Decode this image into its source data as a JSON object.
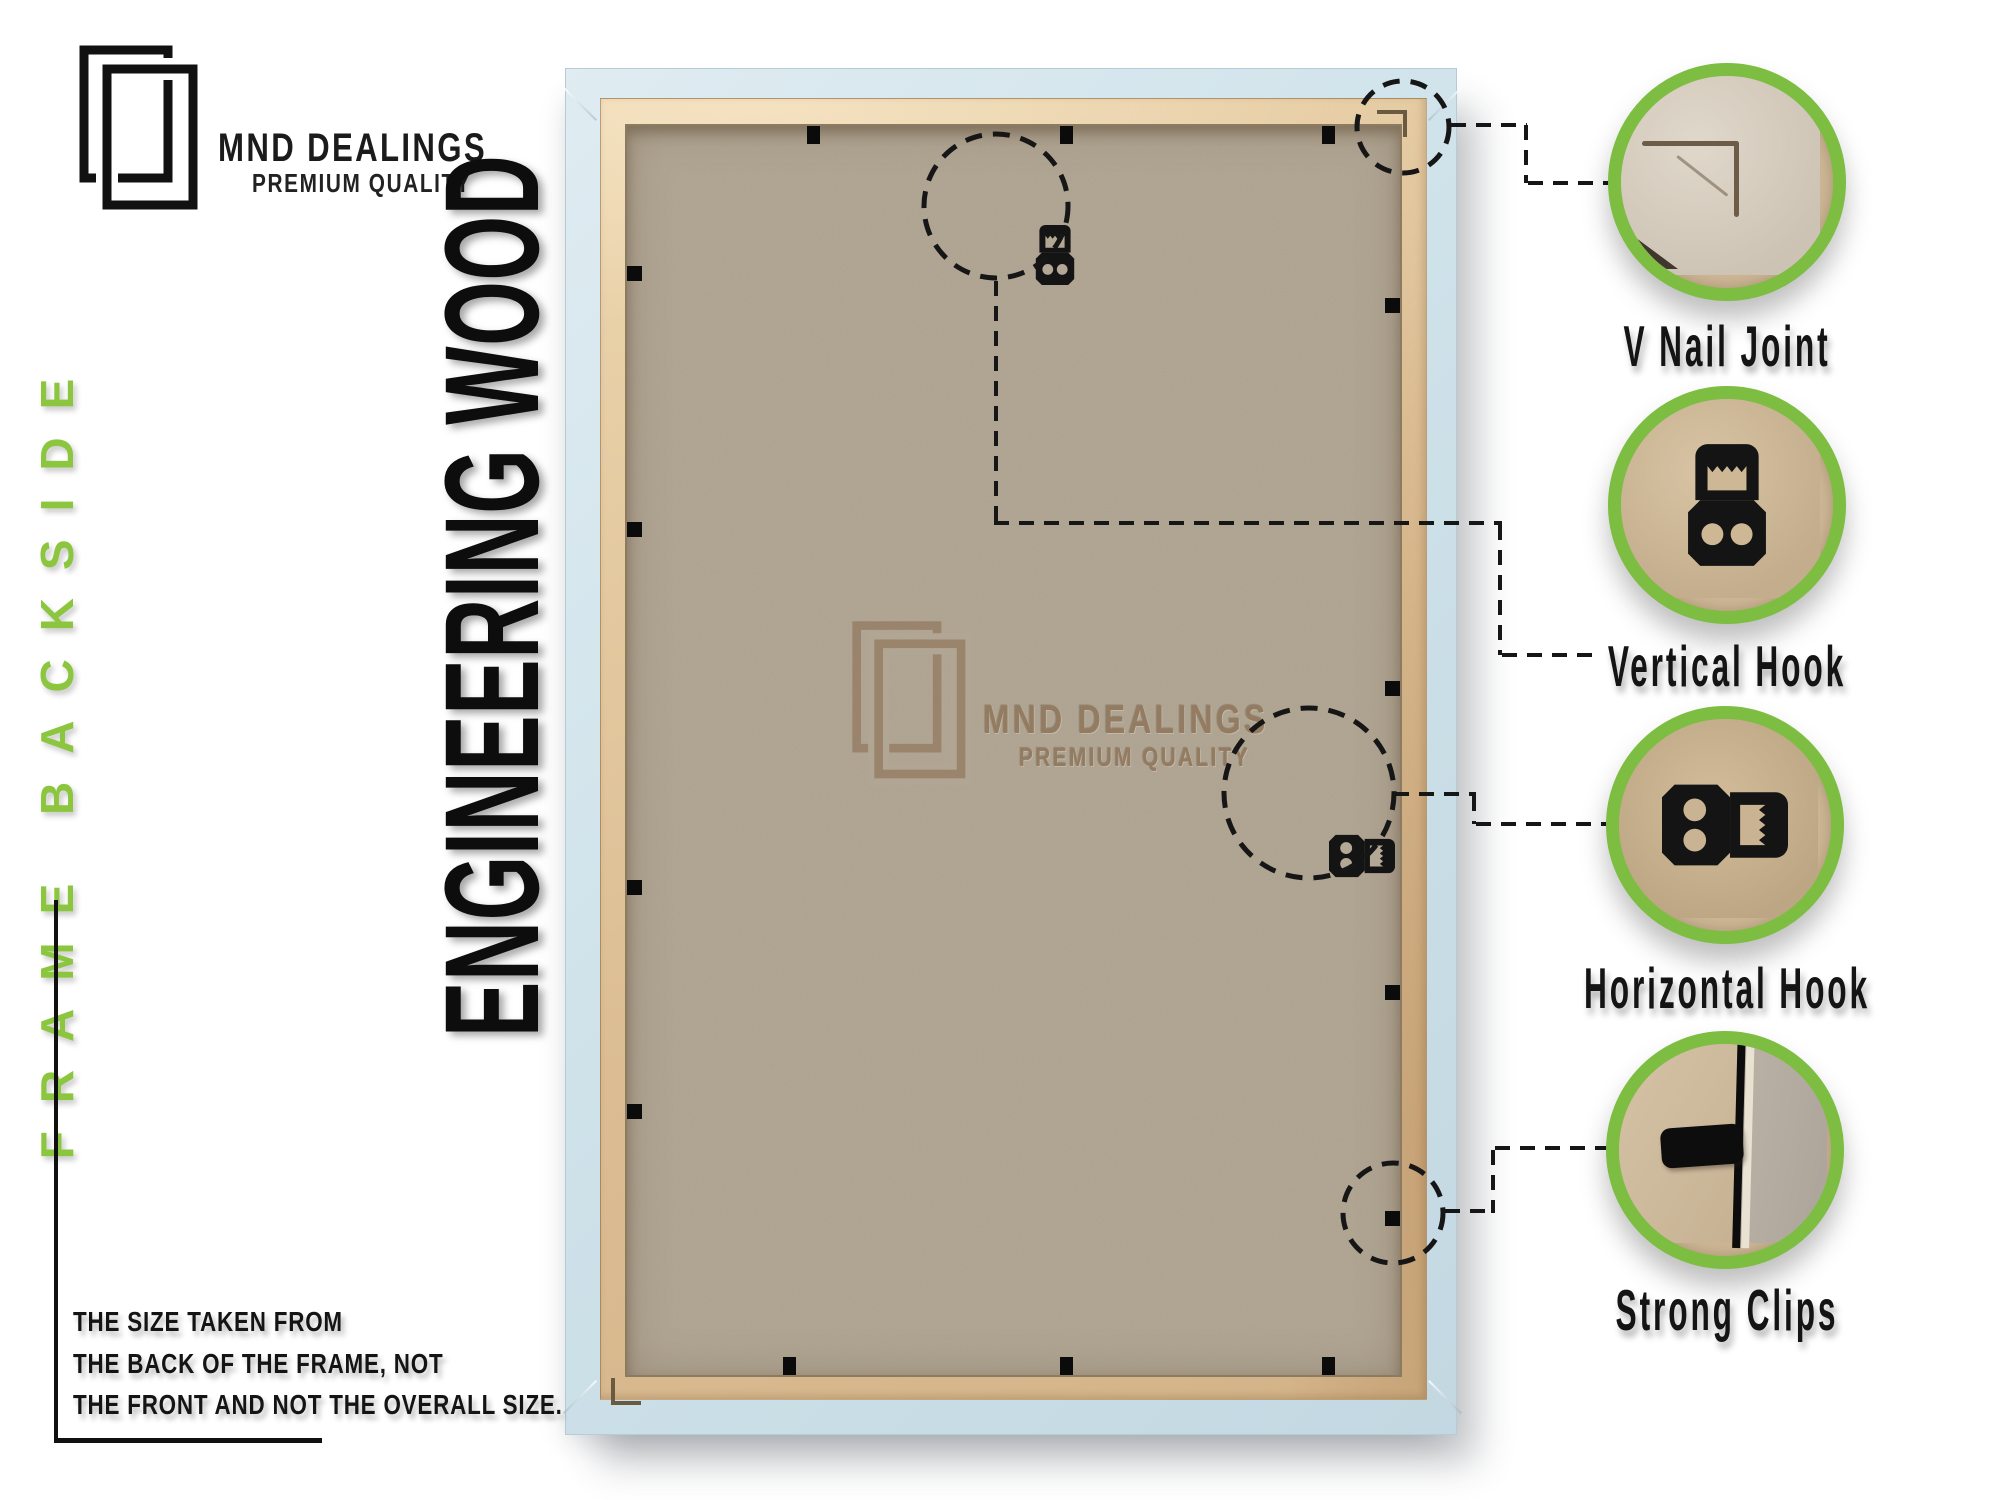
{
  "brand": {
    "name": "MND DEALINGS",
    "tagline": "PREMIUM QUALITY"
  },
  "side_banner": "FRAME BACKSIDE",
  "material_banner": "ENGINEERING WOOD",
  "watermark": {
    "name": "MND DEALINGS",
    "tagline": "PREMIUM QUALITY"
  },
  "callouts": [
    {
      "label": "V Nail Joint"
    },
    {
      "label": "Vertical Hook"
    },
    {
      "label": "Horizontal Hook"
    },
    {
      "label": "Strong Clips"
    }
  ],
  "size_note": {
    "lines": [
      "THE SIZE TAKEN FROM",
      "THE BACK OF THE FRAME, NOT",
      "THE FRONT AND NOT THE OVERALL SIZE."
    ]
  },
  "colors": {
    "accent_green": "#7cbd42",
    "text_green": "#8cc63f",
    "frame_blue": "#cfe2ea",
    "wood_lip": "#dfc29b",
    "mdf_board": "#b2a795",
    "ink": "#141414",
    "watermark_brown": "#8d7257"
  }
}
